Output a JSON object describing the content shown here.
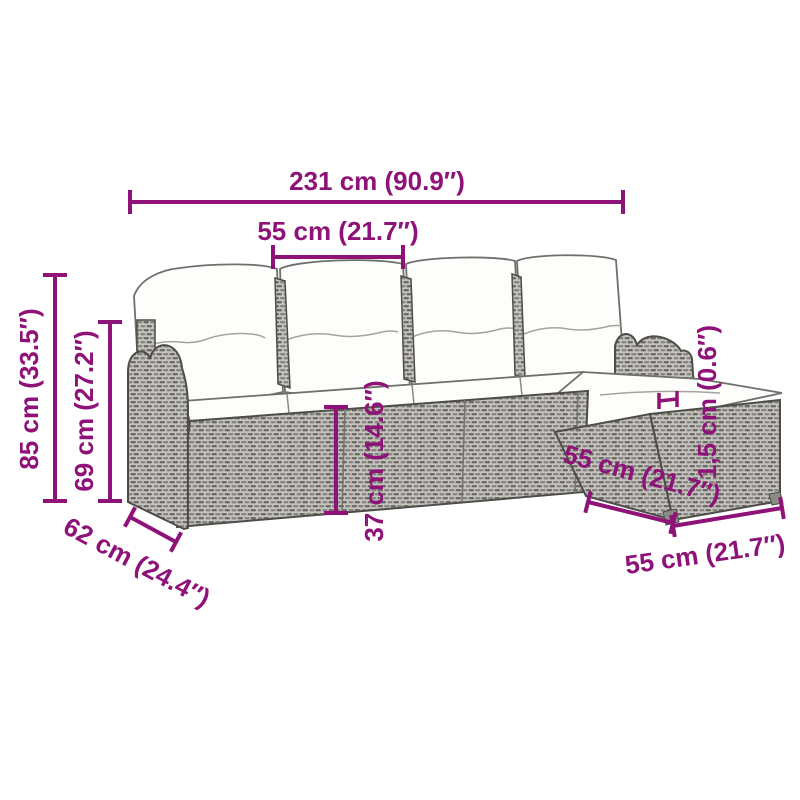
{
  "figure": {
    "illustration_name": "rattan-garden-sofa-set-line-drawing",
    "pieces": [
      "left-armrest-sofa",
      "middle-sofa-seats",
      "corner-seat",
      "ottoman"
    ]
  },
  "colors": {
    "accent": "#8E1278",
    "background": "#ffffff",
    "rattan_light": "#c6c4c0",
    "rattan_dark": "#6d6b64",
    "rattan_mid": "#87857f",
    "outline": "#4f4d49",
    "cushion": "#fdfdfb"
  },
  "dimensions": [
    {
      "id": "overall-width",
      "label": "231 cm (90.9″)"
    },
    {
      "id": "seat-width",
      "label": "55 cm (21.7″)"
    },
    {
      "id": "total-height",
      "label": "85 cm (33.5″)"
    },
    {
      "id": "backrest-height",
      "label": "69 cm (27.2″)"
    },
    {
      "id": "seat-depth",
      "label": "62 cm (24.4″)"
    },
    {
      "id": "seat-height",
      "label": "37 cm (14.6″)"
    },
    {
      "id": "chaise-depth",
      "label": "55 cm (21.7″)"
    },
    {
      "id": "cushion-thickness",
      "label": "1,5 cm (0.6″)"
    },
    {
      "id": "ottoman-width",
      "label": "55 cm (21.7″)"
    }
  ]
}
